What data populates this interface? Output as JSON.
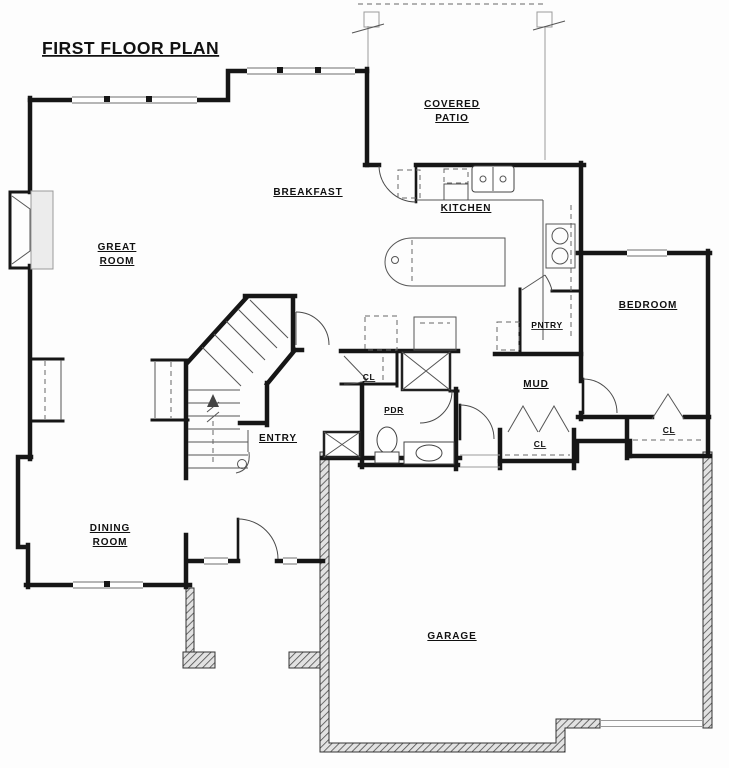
{
  "drawing": {
    "title": "FIRST FLOOR PLAN",
    "type_note": "architectural first floor plan, black line work on white"
  },
  "labels": {
    "covered_patio": {
      "l1": "COVERED",
      "l2": "PATIO"
    },
    "great_room": {
      "l1": "GREAT",
      "l2": "ROOM"
    },
    "dining_room": {
      "l1": "DINING",
      "l2": "ROOM"
    },
    "breakfast": "BREAKFAST",
    "kitchen": "KITCHEN",
    "bedroom": "BEDROOM",
    "pantry": "PNTRY",
    "mud": "MUD",
    "entry": "ENTRY",
    "powder_room": "PDR",
    "closet_entry": "CL",
    "closet_hall": "CL",
    "closet_bedroom": "CL",
    "garage": "GARAGE"
  },
  "colors": {
    "background": "#fdfdfd",
    "wall_ink": "#161616",
    "thin_line": "#555555",
    "light_line": "#9a9a9a",
    "hatch_fill": "#e2e2e2"
  }
}
